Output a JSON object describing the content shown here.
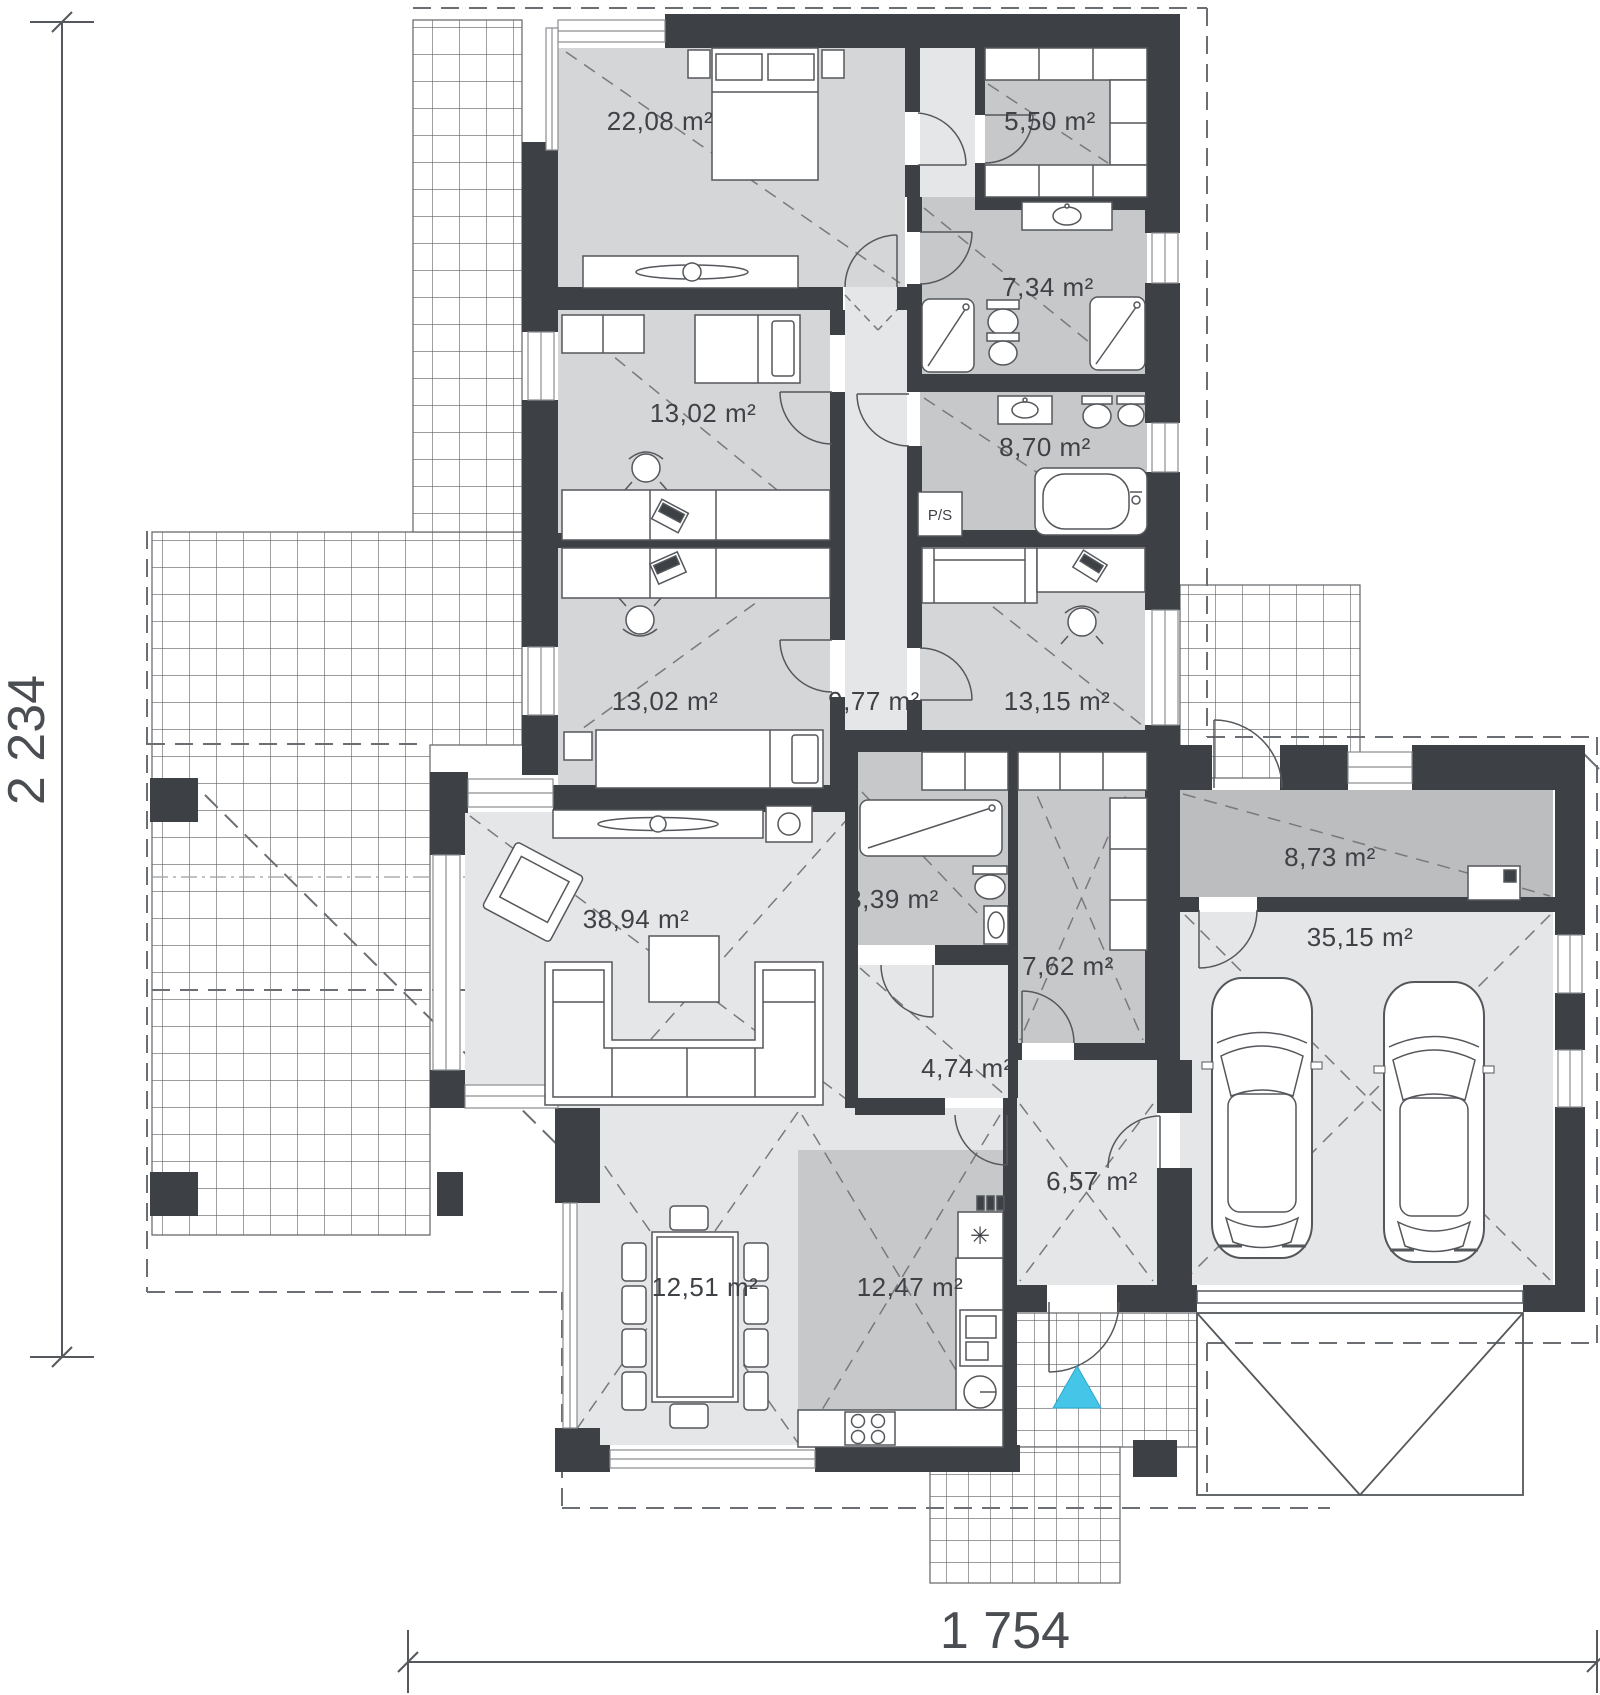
{
  "plan": {
    "dimensions": {
      "height_label": "2 234",
      "width_label": "1 754"
    },
    "rooms": {
      "master_bedroom": {
        "area": "22,08 m²"
      },
      "closet": {
        "area": "5,50 m²"
      },
      "bathroom_main": {
        "area": "7,34 m²"
      },
      "bathroom_family": {
        "area": "8,70 m²"
      },
      "bedroom_1": {
        "area": "13,02 m²"
      },
      "bedroom_2": {
        "area": "13,02 m²"
      },
      "hallway": {
        "area": "9,77 m²"
      },
      "bedroom_3": {
        "area": "13,15 m²"
      },
      "living_room": {
        "area": "38,94 m²"
      },
      "wc": {
        "area": "3,39 m²"
      },
      "pantry": {
        "area": "7,62 m²"
      },
      "corridor": {
        "area": "4,74 m²"
      },
      "entry_hall": {
        "area": "6,57 m²"
      },
      "dining_room": {
        "area": "12,51 m²"
      },
      "kitchen": {
        "area": "12,47 m²"
      },
      "utility": {
        "area": "8,73 m²"
      },
      "garage": {
        "area": "35,15 m²"
      }
    },
    "annotations": {
      "washer_dryer": "P/S",
      "fridge_symbol": "✳"
    },
    "colors": {
      "wall": "#3d4145",
      "accent": "#45c6e8"
    }
  }
}
